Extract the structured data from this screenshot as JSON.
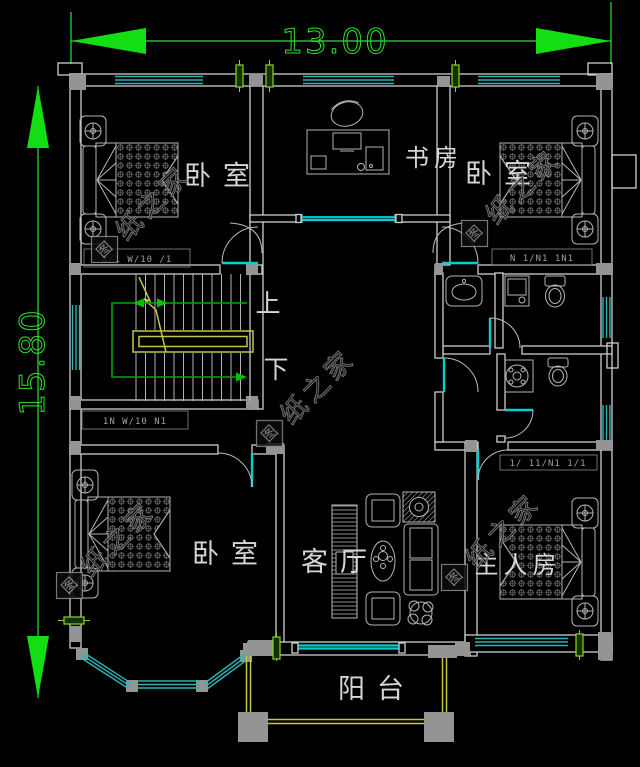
{
  "canvas": {
    "width": 640,
    "height": 767,
    "background": "#000000"
  },
  "dimensions": {
    "top_value": "13.00",
    "left_value": "15.80"
  },
  "rooms": {
    "bedroom_top_left": {
      "label": "卧室"
    },
    "study": {
      "label": "书房"
    },
    "bedroom_top_right": {
      "label": "卧室"
    },
    "bedroom_bottom_left": {
      "label": "卧室"
    },
    "living_room": {
      "label": "客厅"
    },
    "master_bedroom": {
      "label": "主人房"
    },
    "balcony": {
      "label": "阳台"
    }
  },
  "stairs": {
    "up_label": "上",
    "down_label": "下"
  },
  "watermark": {
    "logo_char": "图",
    "text": "纸之家",
    "full_text": "图纸之家"
  },
  "annotations": {
    "row1": "0/1  W/10  /1",
    "row2": "1N  W/10  N1",
    "row3": "N  1/N1  1N1",
    "row4": "1/  11/N1  1/1"
  },
  "colors": {
    "background": "#000000",
    "dimension_green": "#2ee22e",
    "arrow_green": "#13dd13",
    "wall_gray": "#cdcdcd",
    "column_gray": "#949494",
    "window_teal": "#2fb3b3",
    "door_teal": "#00d0d0",
    "stair_rail_yellow": "#c6c646",
    "stair_arrow_green": "#00a800",
    "furniture_gray": "#b5b5b5",
    "label_gray": "#d6d6d6",
    "window_tag_green": "#8ad22b",
    "watermark_gray": "#8e8e8e"
  }
}
